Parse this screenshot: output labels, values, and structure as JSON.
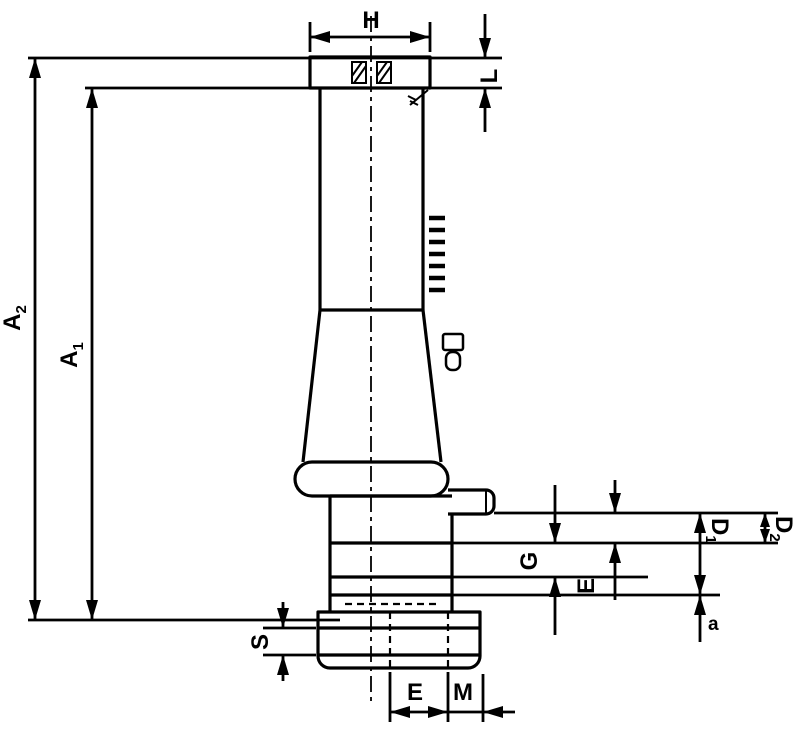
{
  "diagram": {
    "type": "technical-dimension-drawing",
    "colors": {
      "line": "#000000",
      "background": "#ffffff"
    },
    "dimensions": {
      "H": {
        "label": "H"
      },
      "L": {
        "label": "L"
      },
      "A2": {
        "base": "A",
        "sub": "2"
      },
      "A1": {
        "base": "A",
        "sub": "1"
      },
      "S": {
        "label": "S"
      },
      "E_bottom": {
        "label": "E"
      },
      "M": {
        "label": "M"
      },
      "G": {
        "label": "G"
      },
      "E_side": {
        "label": "E"
      },
      "D1": {
        "base": "D",
        "sub": "1"
      },
      "D2": {
        "base": "D",
        "sub": "2"
      },
      "a": {
        "label": "a"
      }
    }
  }
}
